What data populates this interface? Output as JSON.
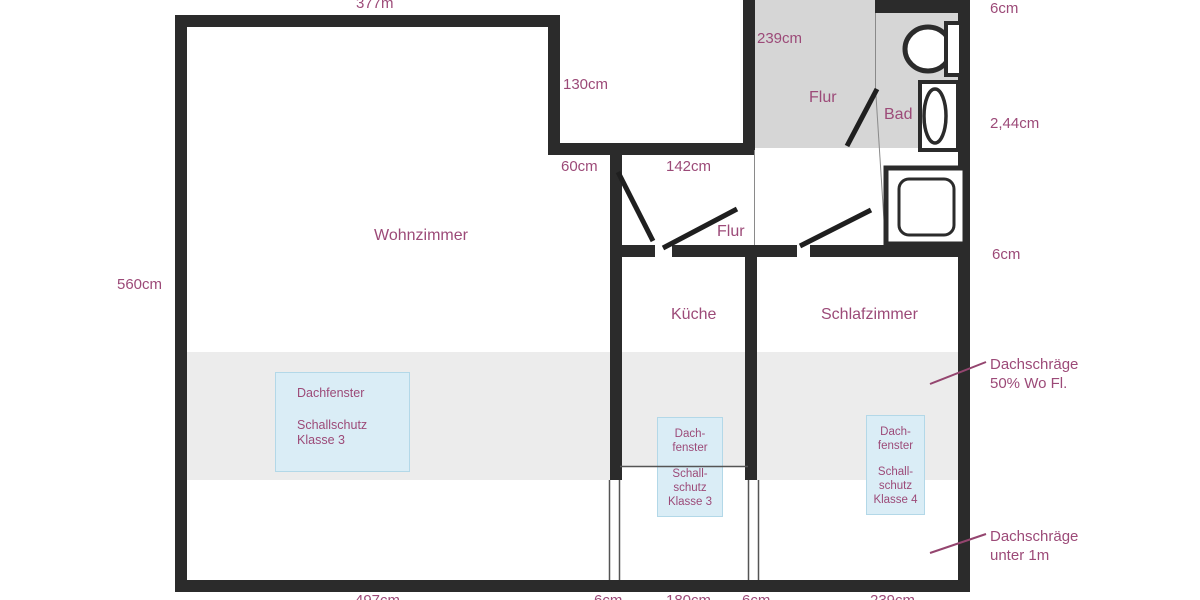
{
  "rooms": {
    "wohnzimmer": "Wohnzimmer",
    "kueche": "Küche",
    "schlafzimmer": "Schlafzimmer",
    "flur_oben": "Flur",
    "flur_unten": "Flur",
    "bad": "Bad"
  },
  "dimensions": {
    "oben_breite": "377m",
    "stufe_hoehe": "130cm",
    "flur_tiefe": "239cm",
    "wand_oben_rechts": "6cm",
    "bad_hoehe": "2,44cm",
    "stufe_breite": "60cm",
    "flur_breite": "142cm",
    "wand_rechts_mitte": "6cm",
    "links_hoehe": "560cm",
    "unten": [
      "497cm",
      "6cm",
      "180cm",
      "6cm",
      "239cm"
    ]
  },
  "skylights": {
    "wohnzimmer": {
      "l1": "Dachfenster",
      "l2": "Schallschutz",
      "l3": "Klasse 3"
    },
    "kueche": {
      "l1": "Dach-",
      "l2": "fenster",
      "l3": "Schall-",
      "l4": "schutz",
      "l5": "Klasse 3"
    },
    "schlafzimmer": {
      "l1": "Dach-",
      "l2": "fenster",
      "l3": "Schall-",
      "l4": "schutz",
      "l5": "Klasse 4"
    }
  },
  "annotations": {
    "schraege50": {
      "l1": "Dachschräge",
      "l2": "50% Wo Fl."
    },
    "schraege1m": {
      "l1": "Dachschräge",
      "l2": "unter 1m"
    }
  },
  "colors": {
    "wall": "#2b2b2b",
    "flur_gray": "#d6d6d6",
    "dachschraege_gray": "#ececec",
    "skylight_fill": "#daedf6",
    "skylight_border": "#b3d8e8",
    "text_purple": "#9c4a78"
  }
}
